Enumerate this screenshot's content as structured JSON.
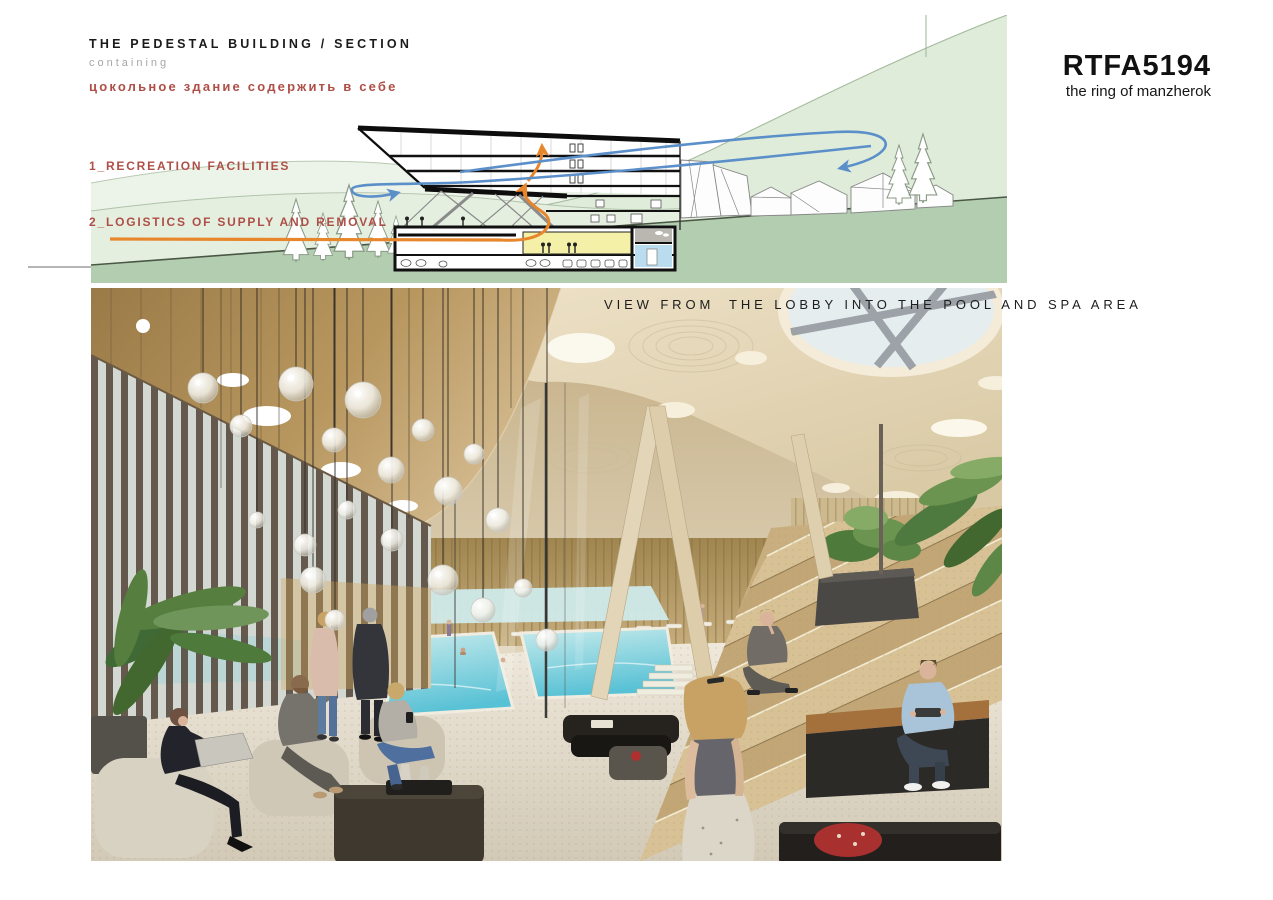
{
  "board": {
    "section": {
      "title": "THE PEDESTAL BUILDING / SECTION",
      "subtitle": "containing",
      "title_ru": "цокольное здание содержить в себе",
      "items": [
        "1_RECREATION FACILITIES",
        "2_LOGISTICS OF SUPPLY AND REMOVAL"
      ]
    },
    "logo": {
      "code": "RTFA5194",
      "tagline": "the ring of manzherok"
    },
    "render": {
      "caption": "VIEW FROM  THE LOBBY INTO THE POOL AND SPA AREA"
    },
    "palette": {
      "accent_red": "#ae4f47",
      "text_black": "#1a1a1a",
      "text_gray": "#a6a6a6",
      "arrow_blue": "#5b8fc9",
      "arrow_orange": "#e8862b",
      "hill_light": "#ecf3e8",
      "hill_mid": "#dfecda",
      "hill_ground": "#b3cdb0",
      "room_yellow": "#f4f0a8",
      "room_blue": "#badcef",
      "room_gray": "#b9b7b0",
      "pool_water": "#5fc3d6",
      "ceiling_bronze": "#b08a54",
      "ceiling_cream": "#e6d9bd",
      "step_tan": "#c3a97c"
    }
  }
}
